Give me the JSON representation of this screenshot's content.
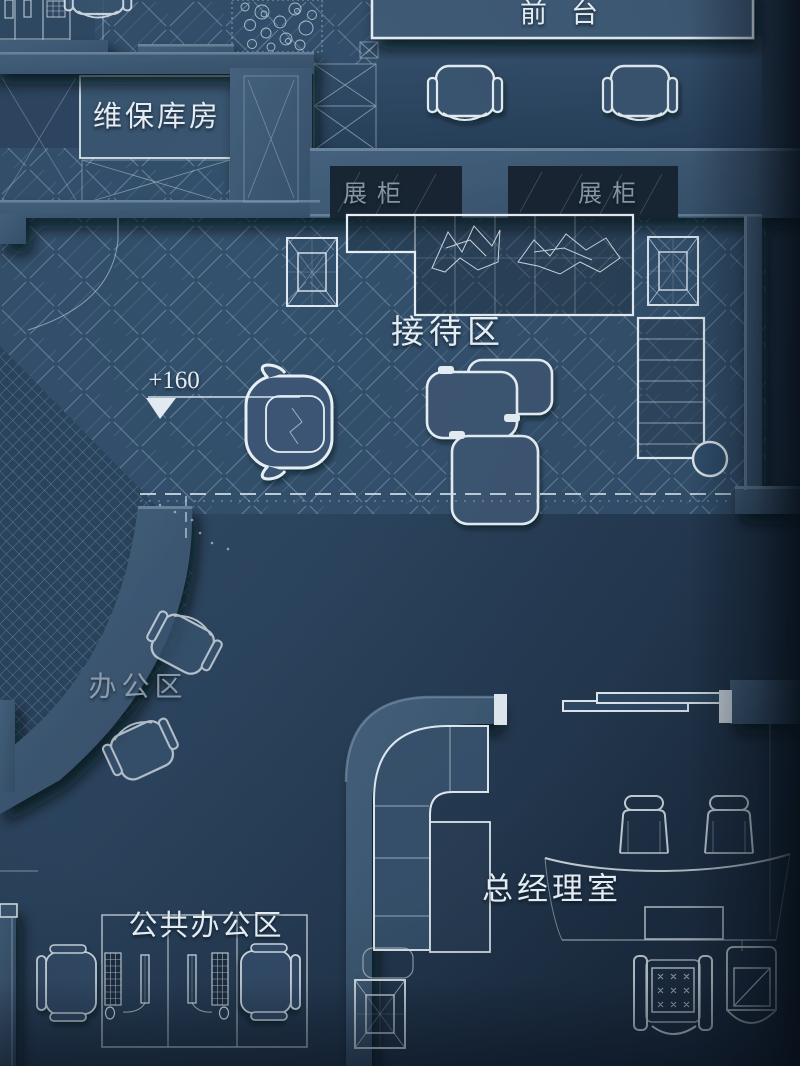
{
  "labels": {
    "front_desk": "前台",
    "maintenance_room": "维保库房",
    "display_case_left": "展柜",
    "display_case_right": "展柜",
    "reception_area": "接待区",
    "elevation_marker": "+160",
    "office_area": "办公区",
    "open_office_area": "公共办公区",
    "gm_office": "总经理室"
  },
  "colors": {
    "wall": "#3e5a76",
    "wall-highlight": "#8aa6bd",
    "floor": "#33506c",
    "floor-dark": "#1e3349",
    "line": "#e9f2f8",
    "label-bright": "#e3ecf3",
    "label-dim": "#9fb0bd"
  }
}
